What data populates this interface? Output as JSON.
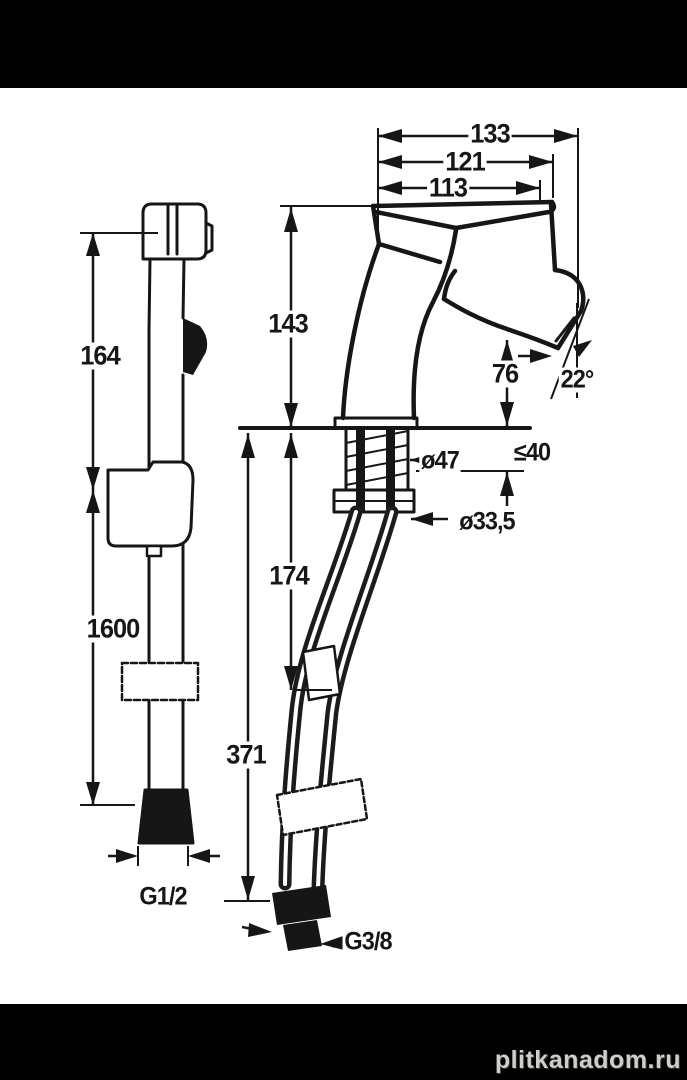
{
  "watermark": "plitkanadom.ru",
  "colors": {
    "background": "#000000",
    "paper": "#ffffff",
    "line": "#161616"
  },
  "hand_shower": {
    "height_to_holder": "164",
    "hose_length": "1600",
    "hose_thread": "G1/2"
  },
  "mixer": {
    "depth_total": "133",
    "depth_handle": "121",
    "depth_spout": "113",
    "height_total": "143",
    "spout_outlet_height": "76",
    "spout_angle": "22°",
    "base_diameter": "ø47",
    "max_mounting_thickness": "≤40",
    "shank_diameter": "ø33,5",
    "tails_length": "174",
    "hose_reach": "371",
    "supply_thread": "G3/8"
  }
}
